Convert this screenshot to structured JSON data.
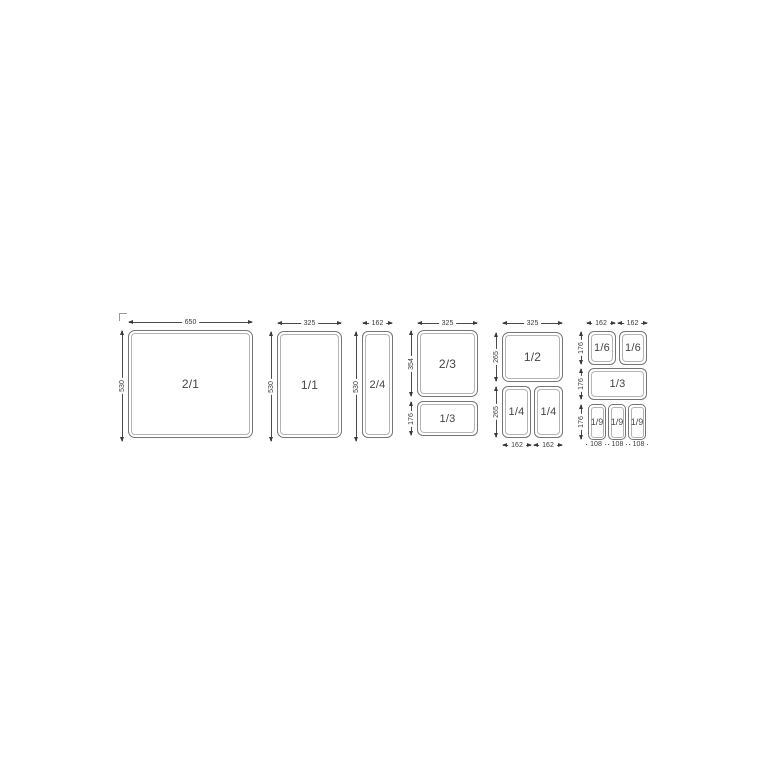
{
  "colors": {
    "line": "#4a4a4a",
    "arrow": "#3a3a3a",
    "pan_border": "#757575",
    "pan_inner": "#b3b3b3",
    "text": "#454545",
    "background": "#ffffff"
  },
  "diagram": {
    "groups": [
      {
        "pans": [
          {
            "label": "2/1"
          }
        ],
        "dims": {
          "top": [
            "650"
          ],
          "left": [
            "530"
          ]
        }
      },
      {
        "pans": [
          {
            "label": "1/1"
          }
        ],
        "dims": {
          "top": [
            "325"
          ],
          "left": [
            "530"
          ]
        }
      },
      {
        "pans": [
          {
            "label": "2/4"
          }
        ],
        "dims": {
          "top": [
            "162"
          ],
          "left": [
            "530"
          ]
        }
      },
      {
        "pans": [
          {
            "label": "2/3"
          },
          {
            "label": "1/3"
          }
        ],
        "dims": {
          "top": [
            "325"
          ],
          "left": [
            "354",
            "176"
          ]
        }
      },
      {
        "pans": [
          {
            "label": "1/2"
          },
          {
            "label": "1/4"
          },
          {
            "label": "1/4"
          }
        ],
        "dims": {
          "top": [
            "325"
          ],
          "left": [
            "265",
            "265"
          ],
          "bottom": [
            "162",
            "162"
          ]
        }
      },
      {
        "pans": [
          {
            "label": "1/6"
          },
          {
            "label": "1/6"
          },
          {
            "label": "1/3"
          },
          {
            "label": "1/9"
          },
          {
            "label": "1/9"
          },
          {
            "label": "1/9"
          }
        ],
        "dims": {
          "top": [
            "162",
            "162"
          ],
          "left": [
            "176",
            "176",
            "176"
          ],
          "bottom": [
            "108",
            "108",
            "108"
          ]
        }
      }
    ]
  }
}
